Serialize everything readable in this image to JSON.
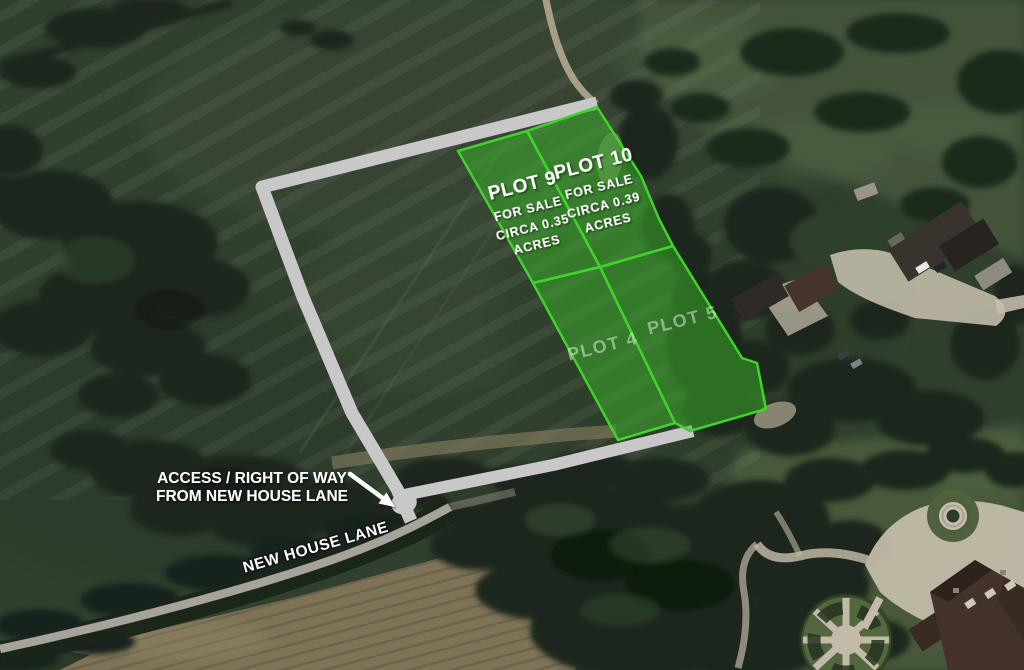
{
  "plots": [
    {
      "id": "plot-9",
      "name": "PLOT 9",
      "status": "FOR SALE",
      "area_line1": "CIRCA 0.35",
      "area_line2": "ACRES"
    },
    {
      "id": "plot-10",
      "name": "PLOT 10",
      "status": "FOR SALE",
      "area_line1": "CIRCA 0.39",
      "area_line2": "ACRES"
    },
    {
      "id": "plot-4",
      "name": "PLOT 4"
    },
    {
      "id": "plot-5",
      "name": "PLOT 5"
    }
  ],
  "annotations": {
    "access_line1": "ACCESS / RIGHT OF WAY",
    "access_line2": "FROM NEW HOUSE LANE",
    "road_name": "NEW HOUSE LANE"
  },
  "colors": {
    "plot_fill": "#3cb32a",
    "plot_border": "#3fd42b",
    "boundary_path": "#c8c8c8",
    "label_white": "#ffffff",
    "road_surface": "#a5a39a"
  }
}
